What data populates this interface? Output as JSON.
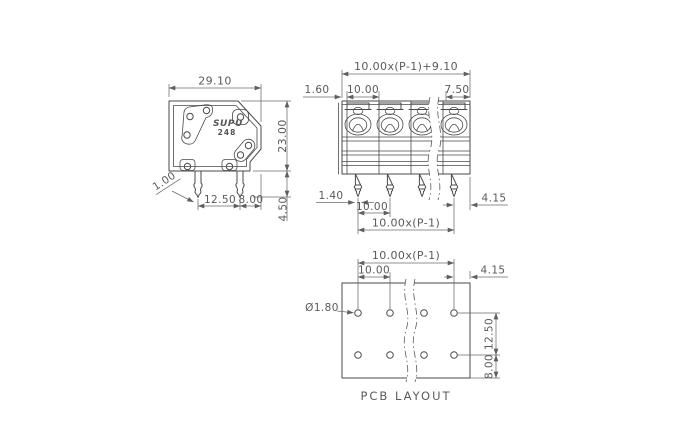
{
  "drawing": {
    "brand": "SUPU",
    "model": "248",
    "side_view": {
      "width": "29.10",
      "height": "23.00",
      "pin_tip": "1.00",
      "pin_spacing": "12.50",
      "pin_edge_offset": "8.00",
      "pin_length": "4.50"
    },
    "front_view": {
      "overall_width": "10.00x(P-1)+9.10",
      "wall_thickness": "1.60",
      "pitch": "10.00",
      "end_width": "7.50",
      "pin_width": "1.40",
      "pin_pitch": "10.00",
      "pin_span": "10.00x(P-1)",
      "pin_edge_offset": "4.15"
    },
    "pcb_layout": {
      "caption": "PCB LAYOUT",
      "hole_span": "10.00x(P-1)",
      "hole_pitch": "10.00",
      "edge_offset": "4.15",
      "hole_diameter": "Ø1.80",
      "row_spacing": "12.50",
      "bottom_offset": "8.00"
    },
    "colors": {
      "line": "#4a4a4a",
      "dimension": "#6b6b6b",
      "text": "#5a5a5a",
      "background": "#ffffff"
    }
  }
}
